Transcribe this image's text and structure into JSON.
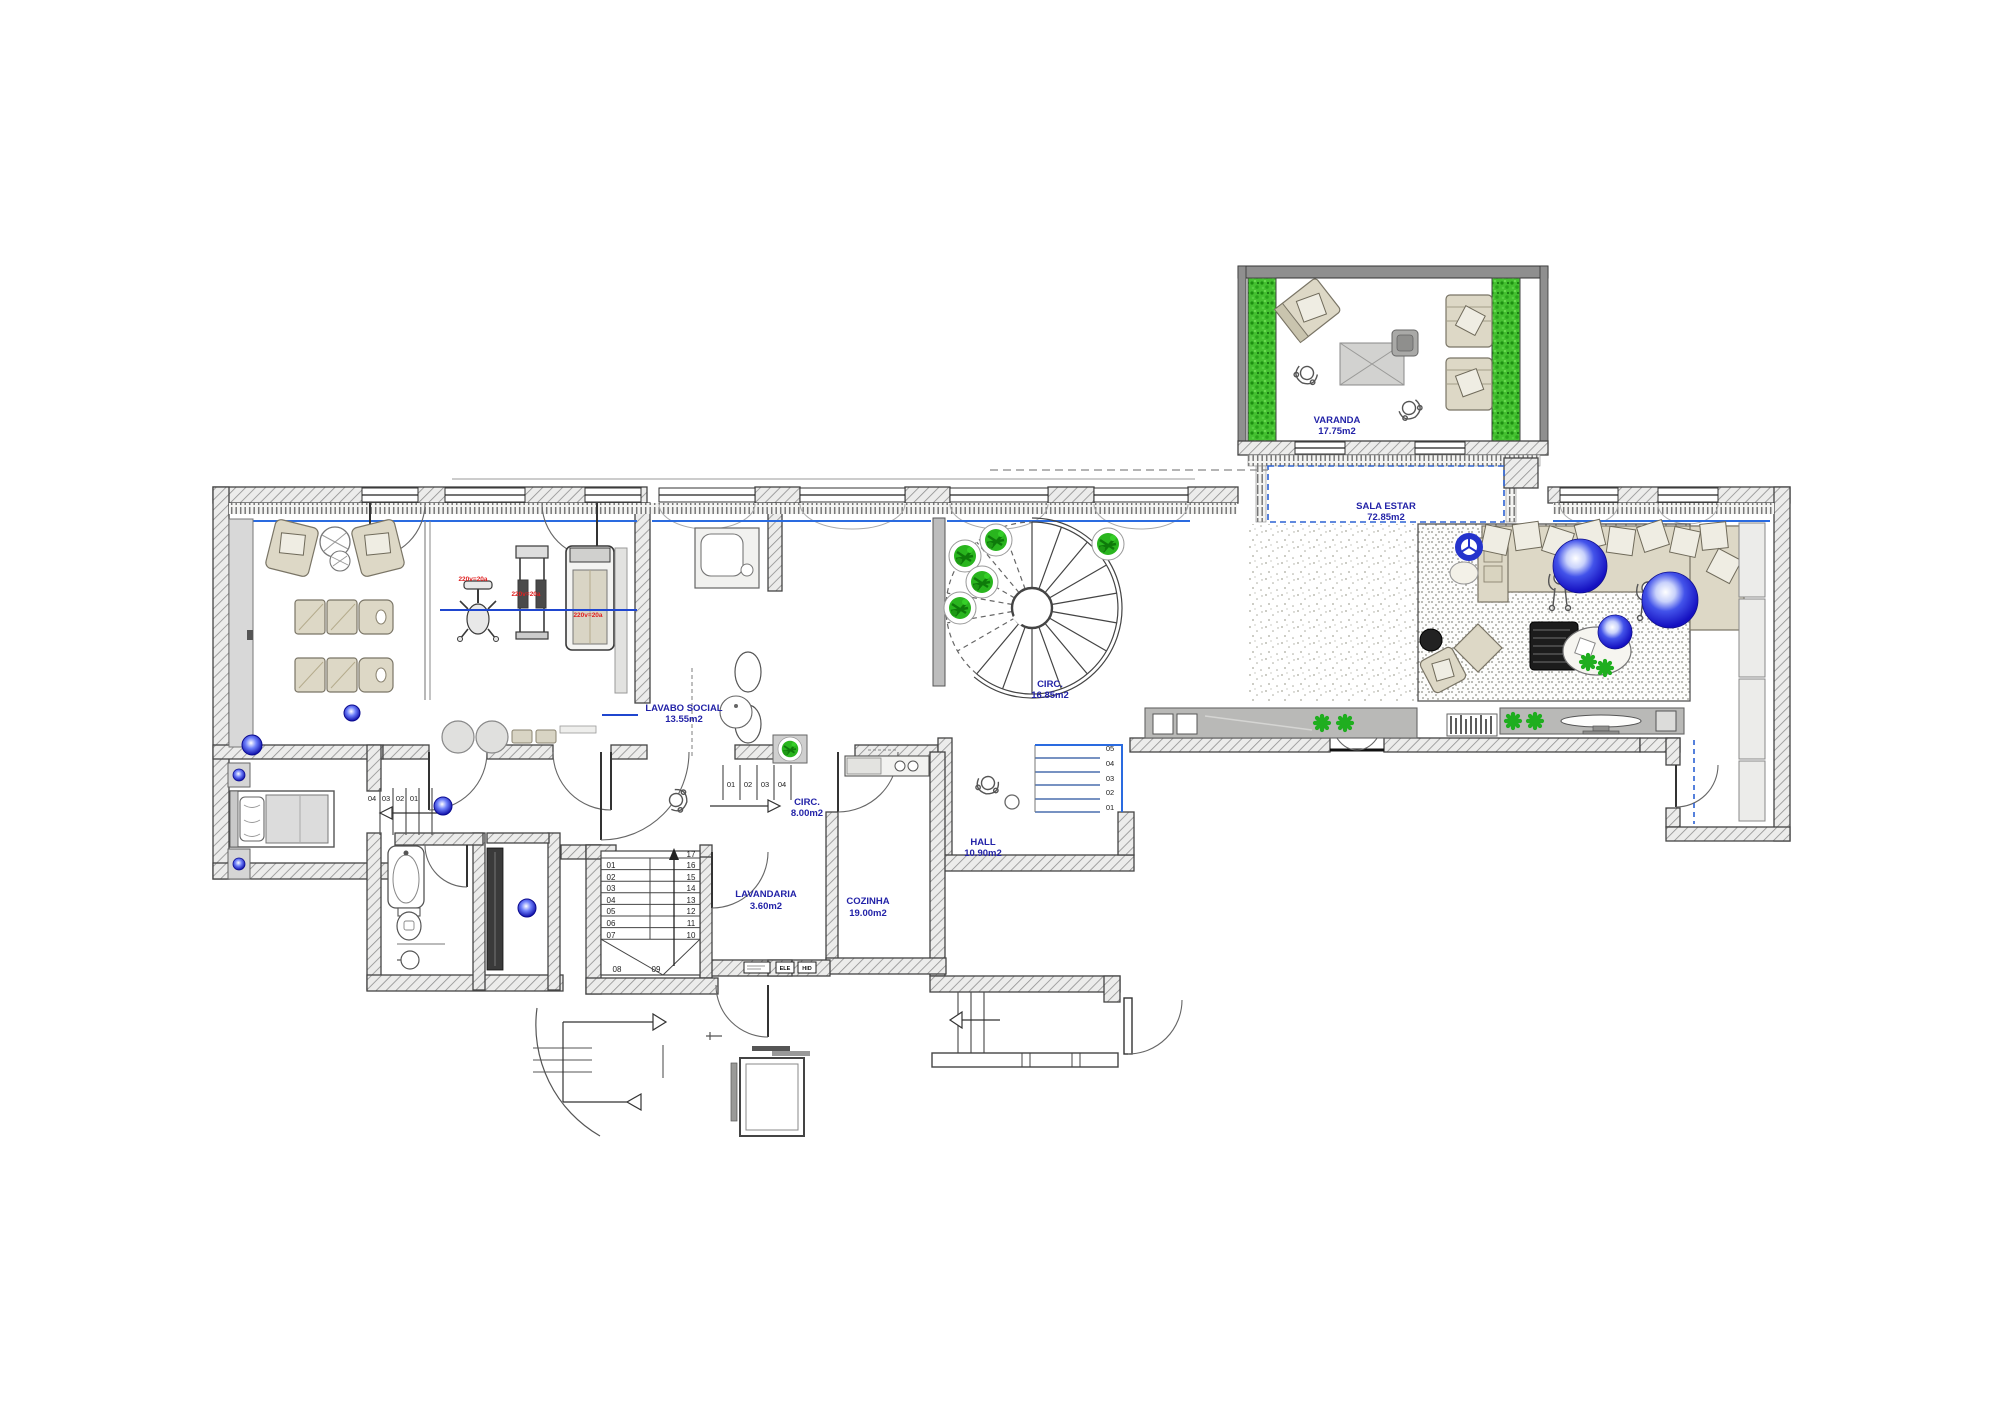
{
  "drawing": {
    "type": "architectural floor plan"
  },
  "colors": {
    "label_blue": "#2323a8",
    "equip_red": "#e02020",
    "line_blue": "#2a6be0",
    "plant_green": "#29b51e",
    "hedge_green": "#44c030",
    "sphere_blue": "#140fc0",
    "wall_gray": "#8f8f8f"
  },
  "rooms": {
    "varanda": {
      "name": "VARANDA",
      "area": "17.75m2"
    },
    "sala_estar": {
      "name": "SALA ESTAR",
      "area": "72.85m2"
    },
    "circ_escada": {
      "name": "CIRC.",
      "area": "16.85m2"
    },
    "lavabo_social": {
      "name": "LAVABO SOCIAL",
      "area": "13.55m2"
    },
    "circ": {
      "name": "CIRC.",
      "area": "8.00m2"
    },
    "hall": {
      "name": "HALL",
      "area": "10.90m2"
    },
    "lavandaria": {
      "name": "LAVANDARIA",
      "area": "3.60m2"
    },
    "cozinha": {
      "name": "COZINHA",
      "area": "19.00m2"
    }
  },
  "equipment_labels": [
    "220v=20a",
    "220v=20a",
    "220v=20a"
  ],
  "panels": {
    "electrical": "ELE",
    "hydraulic": "HID"
  },
  "stairs": {
    "main": [
      "01",
      "02",
      "03",
      "04",
      "05",
      "06",
      "07",
      "08",
      "09",
      "10",
      "11",
      "12",
      "13",
      "14",
      "15",
      "16",
      "17"
    ],
    "hall_steps": [
      "01",
      "02",
      "03",
      "04",
      "05"
    ],
    "circ_steps": [
      "01",
      "02",
      "03",
      "04"
    ],
    "bedroom_steps": [
      "04",
      "03",
      "02",
      "01"
    ]
  }
}
